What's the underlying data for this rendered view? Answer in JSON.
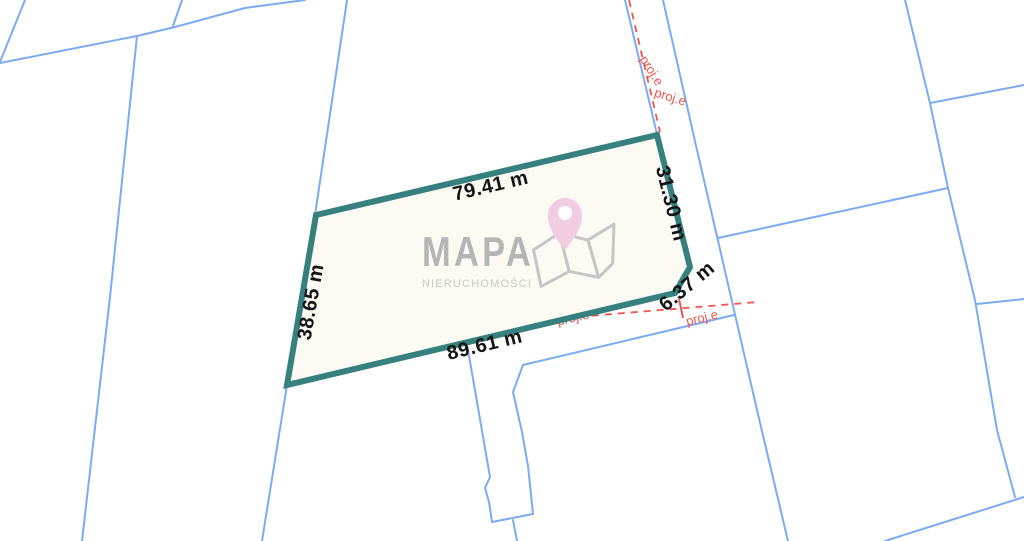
{
  "watermark": {
    "title": "MAPA",
    "subtitle": "NIERUCHOMOŚCI",
    "pin_color": "#f2cde2",
    "logo_color": "#b5b5b5"
  },
  "parcel": {
    "outline_color": "#36807d",
    "fill_color": "#fdfaf4",
    "measurements": {
      "top": "79.41 m",
      "right": "31.30 m",
      "left": "38.65 m",
      "bottom": "89.61 m",
      "corner": "6.37 m"
    }
  },
  "overlays": {
    "proj_label": "proj.e",
    "proj_color": "#ee564d",
    "boundary_color": "#7dabf2"
  }
}
